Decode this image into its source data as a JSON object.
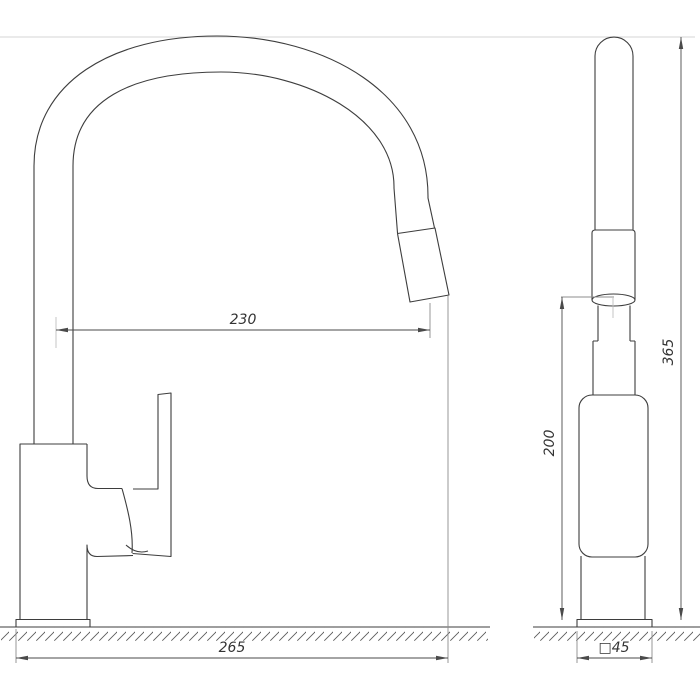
{
  "drawing": {
    "background_color": "#ffffff",
    "object_line_color": "#3d3d3d",
    "dimension_line_color": "#4a4a4a",
    "dimensions": {
      "spout_reach": "230",
      "overall_length": "265",
      "height_to_aerator": "200",
      "overall_height": "365",
      "base_size": "□45"
    }
  }
}
